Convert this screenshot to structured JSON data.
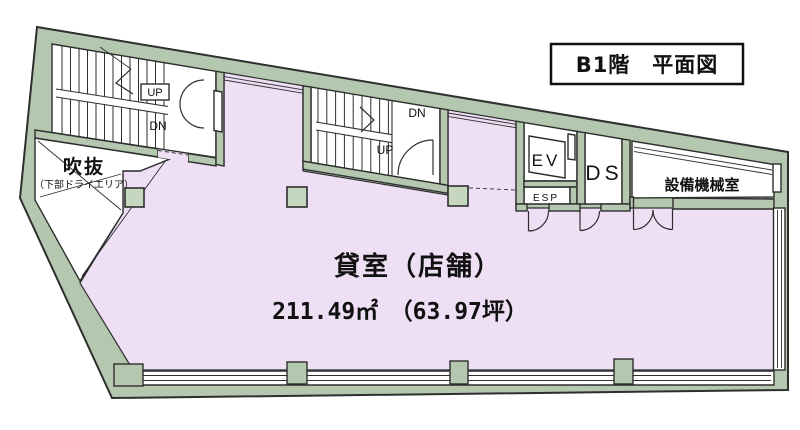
{
  "title": "B1階　平面図",
  "main_room": {
    "name": "貸室（店舗）",
    "area": "211.49㎡　（63.97坪）"
  },
  "void_area": {
    "name": "吹抜",
    "note": "（下部ドライエリア）"
  },
  "equipment_room": "設備機械室",
  "elevator": "EV",
  "esp": "ESP",
  "duct_space": "DS",
  "stairs": {
    "left_up": "UP",
    "left_down": "DN",
    "center_up": "UP",
    "center_down": "DN"
  },
  "colors": {
    "wall": "#b4c8af",
    "floor": "#eedff5",
    "column": "#c6d7c0",
    "line": "#2e2e2e",
    "background": "#ffffff"
  }
}
